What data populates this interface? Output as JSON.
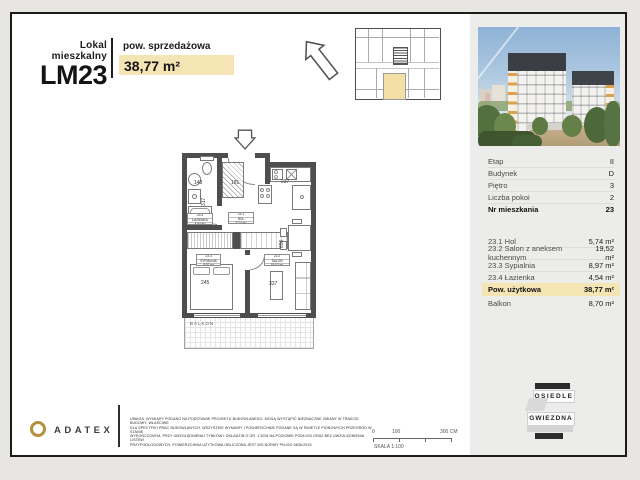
{
  "header": {
    "type_label": "Lokal mieszkalny",
    "unit_code": "LM23",
    "sale_area_label": "pow. sprzedażowa",
    "sale_area_value": "38,77 m²"
  },
  "details_table": {
    "rows": [
      {
        "label": "Etap",
        "value": "II"
      },
      {
        "label": "Budynek",
        "value": "D"
      },
      {
        "label": "Piętro",
        "value": "3"
      },
      {
        "label": "Liczba pokoi",
        "value": "2"
      },
      {
        "label": "Nr mieszkania",
        "value": "23"
      }
    ]
  },
  "rooms_table": {
    "rows": [
      {
        "label": "23.1 Hol",
        "value": "5,74 m²"
      },
      {
        "label": "23.2 Salon z aneksem kuchennym",
        "value": "19,52 m²"
      },
      {
        "label": "23.3 Sypialnia",
        "value": "8,97 m²"
      },
      {
        "label": "23.4 Łazienka",
        "value": "4,54 m²"
      }
    ],
    "total_label": "Pow. użytkowa",
    "total_value": "38,77 m²",
    "balcony_label": "Balkon",
    "balcony_value": "8,70 m²"
  },
  "floor_plan": {
    "balcony_label": "BALKON",
    "dimensions": {
      "d148": "148",
      "d317": "317",
      "d181": "181",
      "d237": "237",
      "d650": "650",
      "d245": "245",
      "d337": "337"
    },
    "room_tags": [
      {
        "no": "23.4",
        "name": "ŁAZIENKA",
        "area": "4,54 m²"
      },
      {
        "no": "23.1",
        "name": "HOL",
        "area": "5,74 m²"
      },
      {
        "no": "23.3",
        "name": "SYPIALNIA",
        "area": "8,97 m²"
      },
      {
        "no": "23.2",
        "name": "SALON",
        "area": "19,52 m²"
      }
    ]
  },
  "scale_bar": {
    "tick_0": "0",
    "tick_100": "100",
    "tick_300": "300 CM",
    "caption": "SKALA 1:100"
  },
  "footer": {
    "brand": "ADATEX",
    "disclaimer": "UWAGA: WYMIARY PODANO NA PODSTAWIE PROJEKTU BUDOWLANEGO. MOGĄ WYSTĄPIĆ NIEZNACZNE ZMIANY W TRAKCIE BUDOWY, WŁAŚCIWE\nDLA SPECYFIKI PRAC BUDOWLANYCH. WSZYSTKIE WYMIARY I POWIERZCHNIE PODANE SĄ W ŚWIETLE PIONOWYCH PRZEGRÓD W STANIE\nWYKOŃCZONYM, PRZY UWZGLĘDNIENIU TYNKÓW I OKŁADZIN O GR. 1,5CM NA POZIOMIE PODŁOGI ORAZ BEZ UWZGLĘDNIENIA LISTEW\nPRZYPODŁOGOWYCH. POWIERZCHNIA UŻYTKOWA OBLICZONA JEST WG NORMY PN-ISO 9836:2015"
  },
  "estate_logo": {
    "word_top": "OSIEDLE",
    "word_bottom": "GWIEZDNA"
  },
  "colors": {
    "highlight_yellow": "#f5e5b4",
    "wall_gray": "#4e4e4e",
    "sidebar_bg": "#ececea",
    "brand_gold": "#b5903f",
    "logo_dark": "#2c2c2c"
  }
}
